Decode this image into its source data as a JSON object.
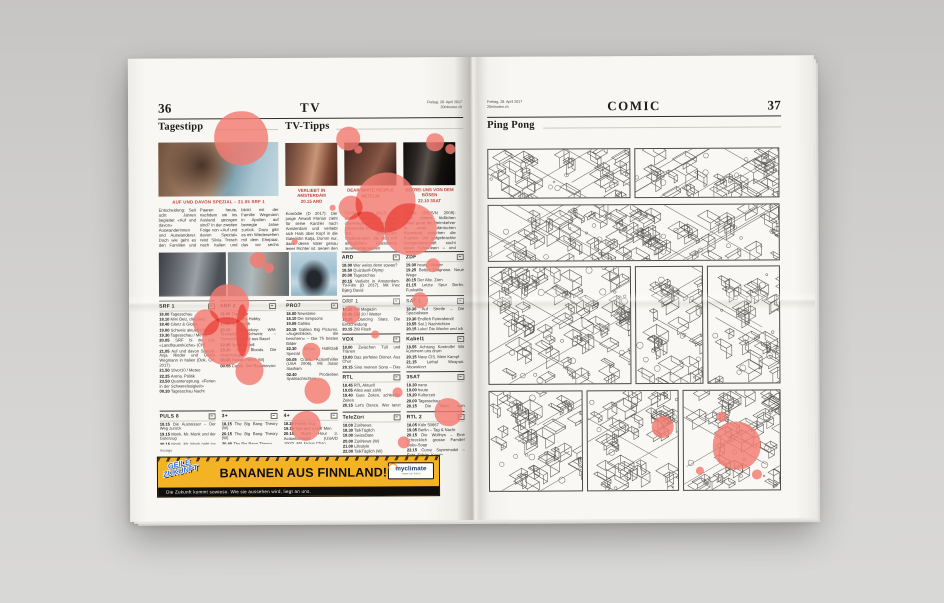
{
  "page_left": {
    "page_number": "36",
    "section": "TV",
    "date": "Freitag, 28. April 2017",
    "site": "20minuten.ch",
    "tagestipp": {
      "heading": "Tagestipp",
      "kicker": "AUF UND DAVON SPEZIAL – 21.05 SRF 1",
      "body": "Entscheidung: Seit acht Jahren begleitet «Auf und davon» Auswanderinnen und Auswanderer. Doch wie geht es den Familien und Paaren heute, nachdem sie ins Ausland gezogen sind? In der zweiten Folge von «Auf und davon Spezial» reist Silvia Tresch nach Italien und blickt mit der Familie Wegmann in Apulien auf bewegte Jahre zurück. Dazu gibt es ein Wiedersehen mit dem Ehepaar, das vor sechs Jahren nach Schweden zog und dort eine kleine Pension führt – und mit Daniel, der in Kanada sein Glück fand. Ein berührender Abend voller Optimismus in der Zekunft-Slot."
    },
    "tvtipps": {
      "heading": "TV-Tipps",
      "items": [
        {
          "title": "VERLIEBT IN AMSTERDAM",
          "slot": "20.15 ARD",
          "body": "Komödie (D 2017): Der junge Anwalt Florian zieht für seine Kanzlei nach Amsterdam und verliebt sich Hals über Kopf in die Galeristin Katja. Dumm nur, dass deren Vater genau jener Richter ist, gegen den er seinen ersten grossen Fall führen soll. Charmante Liebeskomödie mit viel Grachten-Romantik – die TV-Premiere als TV-Premiere."
        },
        {
          "title": "DEAR WHITE PEOPLE",
          "slot": "NETFLIX",
          "body": "TV-Serie (USA 2017): Vor dem Hintergrund einer überwiegend weissen Elite-Universität erzählt die Serie von schwarzen Studierenden, die sich mit alltäglichem Rassismus auseinandersetzen müssen. Scharfzüngig, witzig und hochaktuell – die Adaption des gleichnamigen Kinofilms sorgt schon vor dem Start für Gesprächsstoff. Alle zehn Folgen ab heute."
        },
        {
          "title": "BEFREI UNS VON DEM BÖSEN",
          "slot": "22.10 3SAT",
          "body": "Thriller (DK/S/N 2009): Nach einem tödlichen Unfall gerät ein Heimkehrer in einer dänischen Kleinstadt zwischen die Fronten: Die aufgebrachte Dorfgemeinschaft sucht einen Schuldigen – und findet ihn im Aussenseiter. Ole Bornedals düsterer Film über Vorurteile, Hass und Selbstjustiz ist nichts für schwache Nerven. Heute Nacht auf 3sat."
        }
      ]
    },
    "listings": {
      "tall": [
        {
          "name": "SRF 1",
          "entries": [
            [
              "18.00",
              "Tagesschau"
            ],
            [
              "18.10",
              "Mini Beiz, dini Beiz"
            ],
            [
              "18.40",
              "Glanz & Gloria"
            ],
            [
              "19.00",
              "Schweiz aktuell / Börse"
            ],
            [
              "19.30",
              "Tagesschau / Meteo"
            ],
            [
              "20.05",
              "SRF bi de Lüt. «Landfrauenküche» (CH)"
            ],
            [
              "21.05",
              "Auf und davon Spezial. Anja Rieder und Gisela Wegmann in Italien (Dok, CH, 2017)"
            ],
            [
              "21.50",
              "10vor10 / Meteo"
            ],
            [
              "22.25",
              "Arena. Politik"
            ],
            [
              "23.50",
              "Quantensprung. «Ferien in der Schwerelosigkeit»"
            ],
            [
              "00.20",
              "Tagesschau Nacht"
            ]
          ]
        },
        {
          "name": "SRF 2",
          "entries": [
            [
              "18.05",
              "Top Gear"
            ],
            [
              "19.00",
              "Rock my Hobby"
            ],
            [
              "20.00",
              "Sportflash"
            ],
            [
              "20.10",
              "Eishockey: WM-Testspiel Schweiz – Tschechien. Live aus Basel"
            ],
            [
              "22.45",
              "Sport aktuell"
            ],
            [
              "23.10",
              "Blue Bloods. Die Augenzeugen"
            ],
            [
              "00.00",
              "Hawaii Five-0 (W)"
            ],
            [
              "00.55",
              "Castle. Der Raubtierzoo"
            ]
          ]
        },
        {
          "name": "PRO7",
          "entries": [
            [
              "18.00",
              "Newstime"
            ],
            [
              "18.10",
              "Die Simpsons"
            ],
            [
              "19.05",
              "Galileo"
            ],
            [
              "20.15",
              "Galileo Big Pictures. «Augenblicke, die berühren» – Die 75 besten Bilder"
            ],
            [
              "22.30",
              "Circus HalliGalli Spezial"
            ],
            [
              "00.05",
              "Crank. Actionthriller (USA 2006). Mit Jason Statham"
            ],
            [
              "02.40",
              "ProSieben Spätnachrichten"
            ]
          ]
        }
      ],
      "grid": [
        {
          "name": "ARD",
          "entries": [
            [
              "18.00",
              "Wer weiss denn sowas?"
            ],
            [
              "18.50",
              "Quizduell-Olymp"
            ],
            [
              "20.00",
              "Tagesschau"
            ],
            [
              "20.15",
              "Verliebt in Amsterdam. TV-Film (D 2017). Mit Inez Bjørg David"
            ],
            [
              "21.45",
              "Tatort: Söhne und Väter (W). TV-Krimi (D/B 2009)"
            ],
            [
              "23.15",
              "Tagesthemen"
            ],
            [
              "23.45",
              "Nachtmagazin"
            ]
          ]
        },
        {
          "name": "ZDF",
          "entries": [
            [
              "19.00",
              "heute / Wetter"
            ],
            [
              "19.25",
              "Bettys Diagnose. Neue Wege"
            ],
            [
              "20.15",
              "Der Alte. Zorn"
            ],
            [
              "21.15",
              "Letzte Spur Berlin. Funkstille"
            ],
            [
              "22.00",
              "heute-journal"
            ],
            [
              "22.30",
              "heute-show"
            ],
            [
              "23.00",
              "aspekte"
            ],
            [
              "00.15",
              "Die Filmnacht: 96 Hours. Thriller (F/USA 2008)"
            ]
          ]
        },
        {
          "name": "ORF 1",
          "entries": [
            [
              "18.30",
              "ZIB Magazin"
            ],
            [
              "18.40",
              "ZIB 20 / Wetter"
            ],
            [
              "19.20",
              "Dancing Stars. Die Entscheidung"
            ],
            [
              "20.15",
              "ZIB Flash"
            ],
            [
              "20.20",
              "Dancing Stars. Live-Show"
            ],
            [
              "22.45",
              "ZIB Flash"
            ],
            [
              "22.50",
              "Willkommen Österreich"
            ],
            [
              "23.45",
              "Fussball: 1. Liga, 3. Runde"
            ]
          ]
        },
        {
          "name": "SAT.1",
          "entries": [
            [
              "18.30",
              "Auf Streife – Die Spezialisten"
            ],
            [
              "19.30",
              "Endlich Feierabend!"
            ],
            [
              "19.55",
              "Sat.1 Nachrichten"
            ],
            [
              "20.15",
              "Luke! Die Woche und ich"
            ],
            [
              "22.20",
              "Genial daneben – Das Quiz"
            ],
            [
              "23.20",
              "Knallerkerle"
            ],
            [
              "00.15",
              "Auf Streife (W)"
            ]
          ]
        },
        {
          "name": "VOX",
          "entries": [
            [
              "18.00",
              "Zwischen Tüll und Tränen"
            ],
            [
              "19.00",
              "Das perfekte Dinner. Aus Chur"
            ],
            [
              "20.15",
              "Sing meinen Song – Das Tauschkonzert"
            ],
            [
              "22.15",
              "Prominent! Spezial"
            ],
            [
              "23.00",
              "First Dates – Ein Tisch, zwei Fremde"
            ],
            [
              "00.00",
              "Medical Detectives"
            ]
          ]
        },
        {
          "name": "Kabel1",
          "entries": [
            [
              "18.55",
              "Achtung Kontrolle! Wir kümmern uns drum"
            ],
            [
              "20.15",
              "Navy CIS. Mein Kampf"
            ],
            [
              "21.15",
              "Lethal Weapon. Abgestürzt"
            ],
            [
              "22.10",
              "Hawaii Five-0"
            ],
            [
              "23.05",
              "Mein Lokal, dein Lokal (W)"
            ]
          ]
        },
        {
          "name": "RTL",
          "entries": [
            [
              "18.45",
              "RTL Aktuell"
            ],
            [
              "19.05",
              "Alles was zählt"
            ],
            [
              "19.40",
              "Gute Zeiten, schlechte Zeiten"
            ],
            [
              "20.15",
              "Let's Dance. Wer tanzt mit wem? Die grosse Kennenlernshow"
            ],
            [
              "23.15",
              "Take Me Out"
            ],
            [
              "00.00",
              "RTL Nachtjournal"
            ]
          ]
        },
        {
          "name": "3SAT",
          "entries": [
            [
              "18.30",
              "nano"
            ],
            [
              "19.00",
              "heute"
            ],
            [
              "19.20",
              "Kulturzeit"
            ],
            [
              "20.00",
              "Tagesschau"
            ],
            [
              "20.15",
              "Die Toten vom Bodensee. Krimi (D/A 2014)"
            ],
            [
              "22.10",
              "Befrei uns von dem Bösen. Thriller (DK/S/N 2009). Mit Lasse Rimmer"
            ],
            [
              "23.40",
              "Zapp"
            ]
          ]
        },
        {
          "name": "TeleZüri",
          "entries": [
            [
              "18.00",
              "ZüriNews"
            ],
            [
              "18.30",
              "TalkTäglich"
            ],
            [
              "19.00",
              "SwissDate"
            ],
            [
              "20.00",
              "ZüriNews (W)"
            ],
            [
              "21.00",
              "Lifestyle"
            ],
            [
              "22.00",
              "TalkTäglich (W)"
            ],
            [
              "23.00",
              "ZüriNews (W)"
            ]
          ]
        },
        {
          "name": "RTL 2",
          "entries": [
            [
              "18.05",
              "Köln 50667"
            ],
            [
              "19.05",
              "Berlin – Tag & Nacht"
            ],
            [
              "20.15",
              "Die Wollnys – Eine schrecklich grosse Familie! Doku-Soap"
            ],
            [
              "22.15",
              "Curvy Supermodel – Echt. Schön. Kurvig"
            ],
            [
              "23.10",
              "Autopsie – Mysteriöse Todesfälle"
            ],
            [
              "00.10",
              "Exklusiv – Die Reportage"
            ]
          ]
        }
      ],
      "bottom": [
        {
          "name": "PULS 8",
          "entries": [
            [
              "18.15",
              "Die Ausreisser – Der Weg zurück"
            ],
            [
              "19.15",
              "Monk. Mr. Monk und der Güterzug"
            ],
            [
              "20.15",
              "Monk. Mr. Monk geht ins Gefängnis"
            ],
            [
              "21.15",
              "Liberty Stands Still. Thriller (USA/CDN/D 2002). Mit Wesley Snipes"
            ],
            [
              "23.05",
              "Polizeibericht (W)"
            ]
          ]
        },
        {
          "name": "3+",
          "entries": [
            [
              "18.15",
              "The Big Bang Theory (W)"
            ],
            [
              "20.15",
              "The Big Bang Theory (W)"
            ],
            [
              "20.40",
              "The Big Bang Theory"
            ],
            [
              "21.10",
              "Die Tribute von Panem – Catching Fire. Actionfilm (USA 2013)"
            ],
            [
              "00.10",
              "Mission Schwangerschaft (W)"
            ]
          ]
        },
        {
          "name": "4+",
          "entries": [
            [
              "18.20",
              "Family Guy"
            ],
            [
              "19.15",
              "Two and a Half Men"
            ],
            [
              "20.15",
              "Rush Hour 3. Actionkomödie (USA/D 2007). Mit Jackie Chan"
            ],
            [
              "22.05",
              "Navy CIS. Stacys Rückkehr"
            ],
            [
              "23.55",
              "The Mentalist (W)"
            ]
          ]
        }
      ]
    },
    "ad": {
      "label": "Anzeige",
      "graffiti_line1": "GEILE",
      "graffiti_line2": "ZUKUNFT",
      "headline": "BANANEN AUS FINNLAND!",
      "subline": "Die Zukunft kommt sowieso. Wie sie aussehen wird, liegt an uns.",
      "sponsor": "myclimate",
      "sponsor_tagline": "shape our future"
    }
  },
  "page_right": {
    "page_number": "37",
    "section": "COMIC",
    "date": "Freitag, 28. April 2017",
    "site": "20minuten.ch",
    "comic_title": "Ping Pong"
  },
  "colors": {
    "paper": "#f8f7f3",
    "splatter": "#f37a70",
    "accent_red": "#bf4038",
    "ad_yellow": "#f3b325"
  }
}
